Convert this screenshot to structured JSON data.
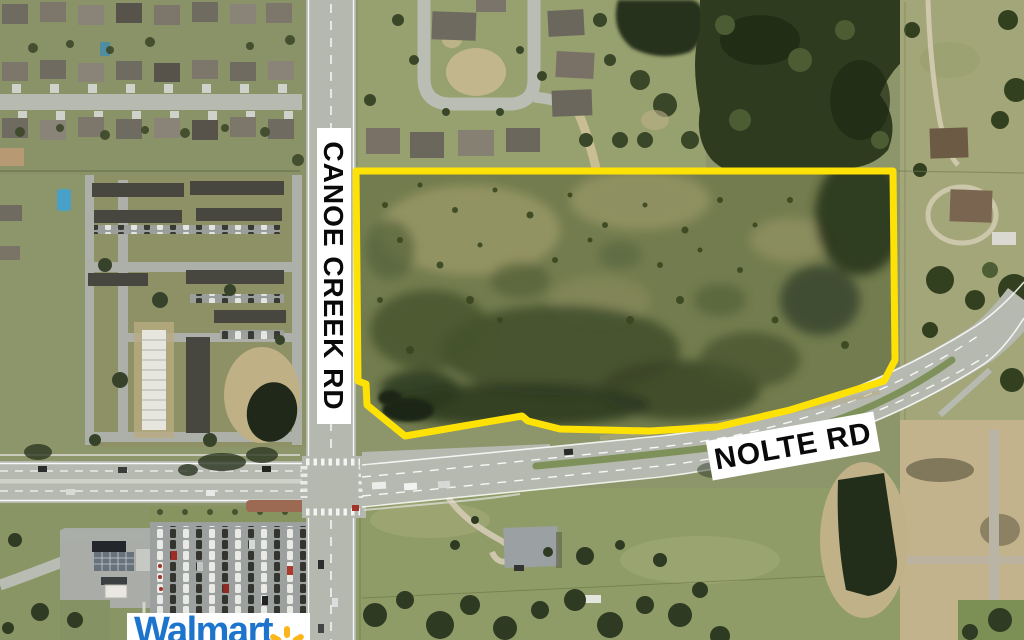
{
  "map": {
    "road_labels": [
      {
        "id": "canoe-creek",
        "text": "CANOE CREEK RD",
        "orientation": "vertical"
      },
      {
        "id": "nolte",
        "text": "NOLTE RD",
        "orientation": "diagonal"
      }
    ],
    "parcel_outline": {
      "color": "#ffe205",
      "stroke_width": 7,
      "path": "M 356 171 L 893 171 L 895 360 L 884 381 L 790 410 L 717 427 L 650 431 L 560 429 L 528 421 L 522 416 L 405 436 L 367 405 L 366 384 L 358 381 Z"
    },
    "store_logo": {
      "text": "Walmart",
      "blue": "#1d74cc",
      "spark_yellow": "#fcb61a"
    }
  }
}
